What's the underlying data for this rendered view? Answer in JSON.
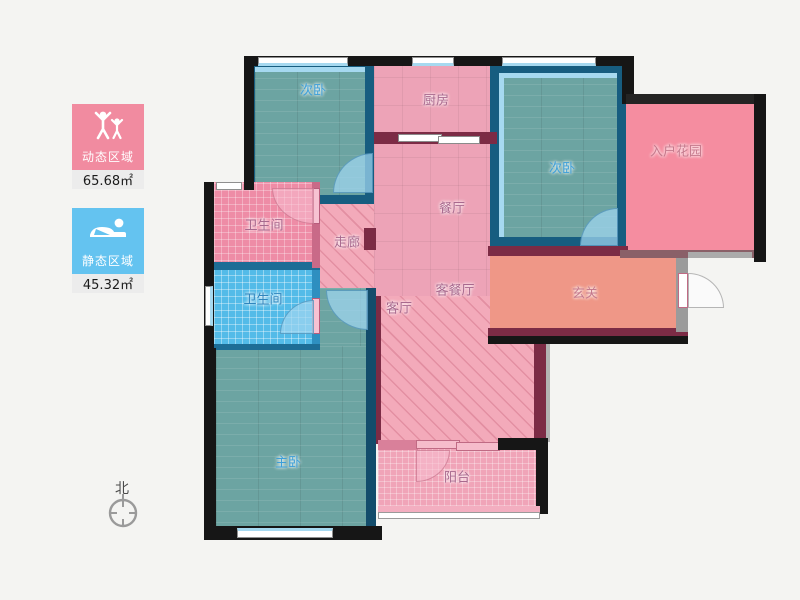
{
  "legend": {
    "dynamic": {
      "label": "动态区域",
      "area": "65.68㎡",
      "color": "#f18ba0",
      "icon": "people-arms-up-icon"
    },
    "static": {
      "label": "静态区域",
      "area": "45.32㎡",
      "color": "#64c3f0",
      "icon": "sleeping-person-icon"
    }
  },
  "compass": {
    "label": "北"
  },
  "rooms": {
    "bedroom_top": {
      "label": "次卧"
    },
    "kitchen": {
      "label": "厨房"
    },
    "bedroom_right": {
      "label": "次卧"
    },
    "entry_garden": {
      "label": "入户花园"
    },
    "dining": {
      "label": "餐厅"
    },
    "corridor": {
      "label": "走廊"
    },
    "bath_upper": {
      "label": "卫生间"
    },
    "bath_lower": {
      "label": "卫生间"
    },
    "living_dining": {
      "label": "客餐厅"
    },
    "living": {
      "label": "客厅"
    },
    "foyer": {
      "label": "玄关"
    },
    "master_bedroom": {
      "label": "主卧"
    },
    "balcony": {
      "label": "阳台"
    }
  },
  "colors": {
    "dynamic_zone": "#f18ba0",
    "static_zone": "#64c3f0",
    "bedroom_floor": "#6ca4a2",
    "bedroom_wall": "#175d80",
    "pink_tile": "#eda3b7",
    "pink_hatch": "#f3aaba",
    "bath_blue": "#53bbe8",
    "bath_pink": "#ee8ca6",
    "foyer_salmon": "#ef9787",
    "garden_pink": "#f58da0",
    "interior_wall": "#7c2b45",
    "outer_wall": "#161616"
  }
}
